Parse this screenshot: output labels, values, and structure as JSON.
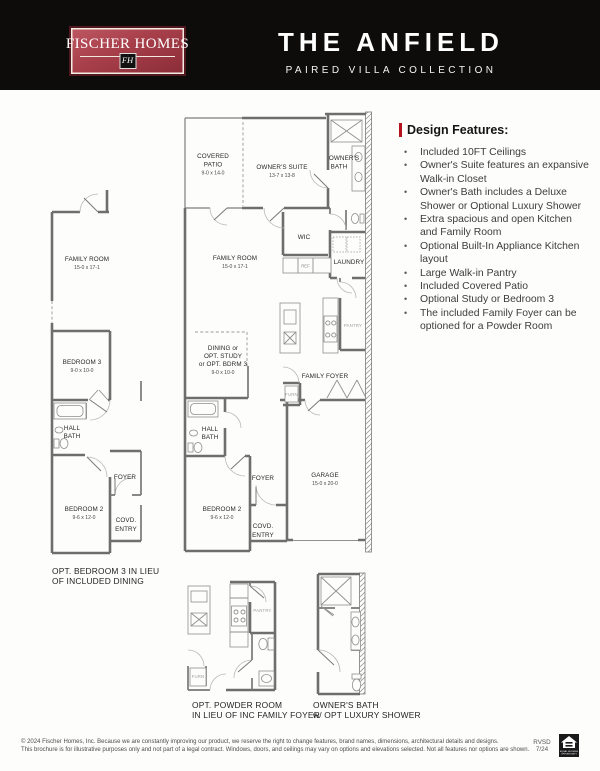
{
  "header": {
    "logo": {
      "name": "FISCHER HOMES",
      "monogram": "FH"
    },
    "title": "THE ANFIELD",
    "subtitle": "PAIRED VILLA COLLECTION"
  },
  "design_features": {
    "heading": "Design Features:",
    "items": [
      "Included 10FT Ceilings",
      "Owner's Suite features an expansive Walk-in Closet",
      "Owner's Bath includes a Deluxe Shower or Optional Luxury Shower",
      "Extra spacious and open Kitchen and Family Room",
      "Optional Built-In Appliance Kitchen layout",
      "Large Walk-in Pantry",
      "Included Covered Patio",
      "Optional Study or Bedroom 3",
      "The included Family Foyer can be optioned for a Powder Room"
    ]
  },
  "plans": {
    "main": {
      "covered_patio_1": "COVERED",
      "covered_patio_2": "PATIO",
      "covered_patio_dims": "9-0 x 14-0",
      "owners_suite": "OWNER'S SUITE",
      "owners_suite_dims": "13-7 x 13-8",
      "owners_bath_1": "OWNER'S",
      "owners_bath_2": "BATH",
      "wic": "WIC",
      "laundry": "LAUNDRY",
      "ref": "REF",
      "family_room": "FAMILY ROOM",
      "family_room_dims": "15-0 x 17-1",
      "pantry": "PANTRY",
      "dining_1": "DINING or",
      "dining_2": "OPT. STUDY",
      "dining_3": "or OPT. BDRM 3",
      "dining_dims": "9-0 x 10-0",
      "family_foyer": "FAMILY FOYER",
      "furn": "FURN",
      "hall_bath_1": "HALL",
      "hall_bath_2": "BATH",
      "foyer": "FOYER",
      "bedroom2": "BEDROOM 2",
      "bedroom2_dims": "9-6 x 12-0",
      "covd_entry_1": "COVD.",
      "covd_entry_2": "ENTRY",
      "garage": "GARAGE",
      "garage_dims": "15-0 x 20-0"
    },
    "left": {
      "family_room": "FAMILY ROOM",
      "family_room_dims": "15-0 x 17-1",
      "bedroom3": "BEDROOM 3",
      "bedroom3_dims": "9-0 x 10-0",
      "hall_bath_1": "HALL",
      "hall_bath_2": "BATH",
      "bedroom2": "BEDROOM 2",
      "bedroom2_dims": "9-6 x 12-0",
      "foyer": "FOYER",
      "covd_entry_1": "COVD.",
      "covd_entry_2": "ENTRY",
      "caption_1": "OPT. BEDROOM 3 IN LIEU",
      "caption_2": "OF INCLUDED DINING"
    },
    "opt_powder": {
      "pantry": "PANTRY",
      "furn": "FURN",
      "caption_1": "OPT. POWDER ROOM",
      "caption_2": "IN LIEU OF INC FAMILY FOYER"
    },
    "opt_bath": {
      "caption_1": "OWNER'S BATH",
      "caption_2": "w/ OPT LUXURY SHOWER"
    }
  },
  "footer": {
    "line1": "© 2024 Fischer Homes, Inc. Because we are constantly improving our product, we reserve the right to change features, brand names, dimensions, architectural details and designs.",
    "line2": "This brochure is for illustrative purposes only and not part of a legal contract. Windows, doors, and ceilings may vary on options and elevations selected. Not all features nor options are shown.",
    "revision_1": "RVSD",
    "revision_2": "7/24",
    "eho_1": "EQUAL HOUSING",
    "eho_2": "OPPORTUNITY"
  },
  "colors": {
    "header_bg": "#0d0c0a",
    "logo_red": "#a73f4a",
    "accent_red": "#b5121f",
    "wall_gray": "#6e6e6e"
  }
}
